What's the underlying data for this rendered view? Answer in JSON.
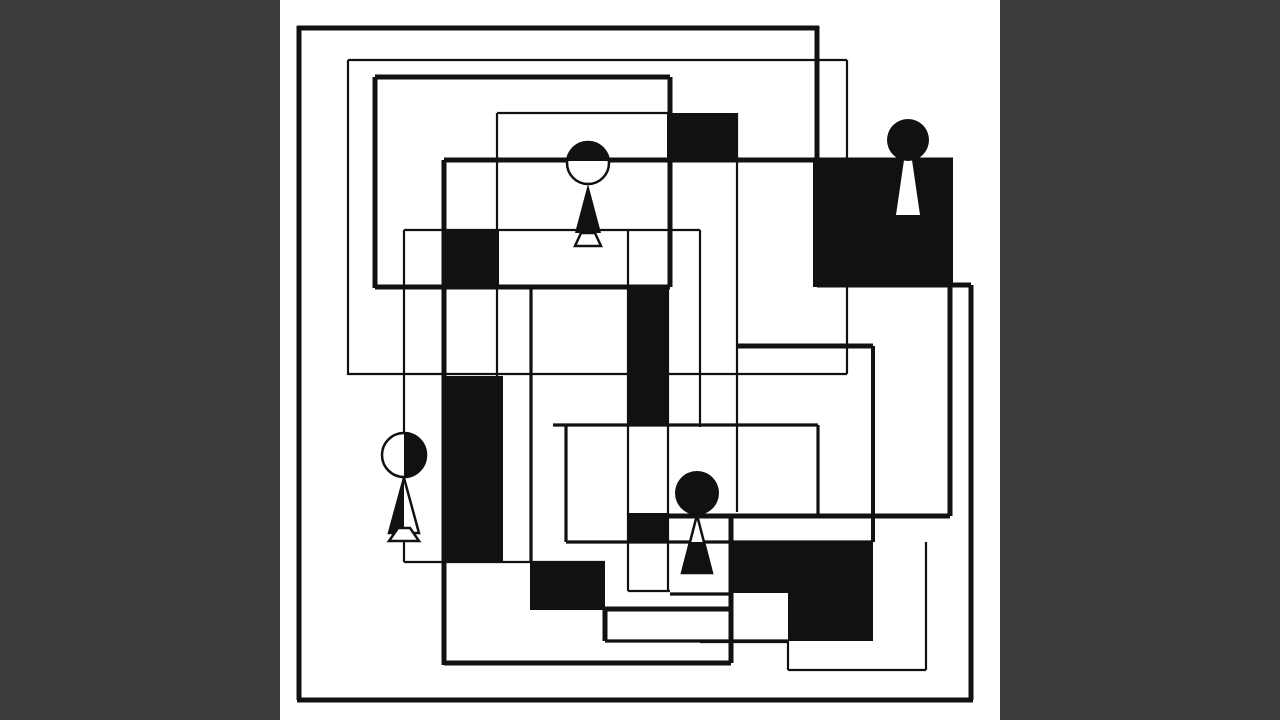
{
  "artwork": {
    "title": "abstract-geometric-composition",
    "canvas_width": 1280,
    "canvas_height": 720,
    "colors": {
      "letterbox": "#3c3c3c",
      "board": "#ffffff",
      "ink": "#111111"
    },
    "board": {
      "x": 280,
      "y": 0,
      "width": 720,
      "height": 720
    },
    "stroke_weights": {
      "thick": 5,
      "medium": 3.2,
      "thin": 2.2
    },
    "filled_blocks": [
      {
        "name": "block-top-center",
        "x": 667,
        "y": 113,
        "w": 70,
        "h": 47
      },
      {
        "name": "block-top-right-square",
        "x": 813,
        "y": 159,
        "w": 140,
        "h": 128
      },
      {
        "name": "block-upper-left-square",
        "x": 444,
        "y": 230,
        "w": 55,
        "h": 57
      },
      {
        "name": "block-left-tall-band",
        "x": 444,
        "y": 376,
        "w": 59,
        "h": 187
      },
      {
        "name": "block-center-tall-band",
        "x": 628,
        "y": 287,
        "w": 40,
        "h": 138
      },
      {
        "name": "block-center-small",
        "x": 628,
        "y": 513,
        "w": 40,
        "h": 28
      },
      {
        "name": "block-bottom-left",
        "x": 530,
        "y": 562,
        "w": 75,
        "h": 48
      },
      {
        "name": "block-bottom-right-a",
        "x": 731,
        "y": 542,
        "w": 142,
        "h": 51
      },
      {
        "name": "block-bottom-right-b",
        "x": 788,
        "y": 593,
        "w": 85,
        "h": 48
      }
    ],
    "segments": [
      {
        "name": "outer-top",
        "x1": 297,
        "y1": 28,
        "x2": 819,
        "y2": 28,
        "w": 5
      },
      {
        "name": "outer-left",
        "x1": 299,
        "y1": 26,
        "x2": 299,
        "y2": 700,
        "w": 5
      },
      {
        "name": "outer-bottom",
        "x1": 297,
        "y1": 700,
        "x2": 973,
        "y2": 700,
        "w": 5
      },
      {
        "name": "outer-right",
        "x1": 971,
        "y1": 285,
        "x2": 971,
        "y2": 700,
        "w": 5
      },
      {
        "name": "right-top-stub",
        "x1": 817,
        "y1": 285,
        "x2": 971,
        "y2": 285,
        "w": 5
      },
      {
        "name": "outer-top-right-drop",
        "x1": 817,
        "y1": 26,
        "x2": 817,
        "y2": 160,
        "w": 5
      },
      {
        "name": "mid-thick-top",
        "x1": 444,
        "y1": 160,
        "x2": 953,
        "y2": 160,
        "w": 5
      },
      {
        "name": "mid-thick-right",
        "x1": 950,
        "y1": 160,
        "x2": 950,
        "y2": 516,
        "w": 5
      },
      {
        "name": "mid-thick-bottom",
        "x1": 628,
        "y1": 516,
        "x2": 950,
        "y2": 516,
        "w": 5
      },
      {
        "name": "mid-thick-left",
        "x1": 444,
        "y1": 160,
        "x2": 444,
        "y2": 665,
        "w": 5
      },
      {
        "name": "lower-thick-bottom",
        "x1": 444,
        "y1": 663,
        "x2": 731,
        "y2": 663,
        "w": 5
      },
      {
        "name": "lower-thick-right",
        "x1": 731,
        "y1": 514,
        "x2": 731,
        "y2": 663,
        "w": 5
      },
      {
        "name": "lower-step-top",
        "x1": 605,
        "y1": 609,
        "x2": 731,
        "y2": 609,
        "w": 5
      },
      {
        "name": "lower-step-left",
        "x1": 605,
        "y1": 609,
        "x2": 605,
        "y2": 641,
        "w": 5
      },
      {
        "name": "lower-step-bottom",
        "x1": 605,
        "y1": 641,
        "x2": 788,
        "y2": 641,
        "w": 3.2
      },
      {
        "name": "tl-rect-top",
        "x1": 375,
        "y1": 77,
        "x2": 670,
        "y2": 77,
        "w": 5
      },
      {
        "name": "tl-rect-left",
        "x1": 375,
        "y1": 77,
        "x2": 375,
        "y2": 288,
        "w": 5
      },
      {
        "name": "tl-rect-bottom",
        "x1": 375,
        "y1": 287,
        "x2": 670,
        "y2": 287,
        "w": 5
      },
      {
        "name": "tl-rect-right",
        "x1": 670,
        "y1": 77,
        "x2": 670,
        "y2": 287,
        "w": 5
      },
      {
        "name": "thin1-top",
        "x1": 348,
        "y1": 60,
        "x2": 847,
        "y2": 60,
        "w": 2.2
      },
      {
        "name": "thin1-left",
        "x1": 348,
        "y1": 60,
        "x2": 348,
        "y2": 375,
        "w": 2.2
      },
      {
        "name": "thin1-bottom",
        "x1": 348,
        "y1": 374,
        "x2": 847,
        "y2": 374,
        "w": 2.2
      },
      {
        "name": "thin1-right",
        "x1": 847,
        "y1": 60,
        "x2": 847,
        "y2": 374,
        "w": 2.2
      },
      {
        "name": "thin2-top",
        "x1": 497,
        "y1": 113,
        "x2": 670,
        "y2": 113,
        "w": 2.2
      },
      {
        "name": "thin2-left",
        "x1": 497,
        "y1": 113,
        "x2": 497,
        "y2": 376,
        "w": 2.2
      },
      {
        "name": "thin3-top",
        "x1": 404,
        "y1": 230,
        "x2": 700,
        "y2": 230,
        "w": 2.2
      },
      {
        "name": "thin3-left",
        "x1": 404,
        "y1": 230,
        "x2": 404,
        "y2": 562,
        "w": 2.2
      },
      {
        "name": "thin3-bottom",
        "x1": 404,
        "y1": 562,
        "x2": 605,
        "y2": 562,
        "w": 2.2
      },
      {
        "name": "thin3-right",
        "x1": 700,
        "y1": 230,
        "x2": 700,
        "y2": 427,
        "w": 2.2
      },
      {
        "name": "mid-medium-h",
        "x1": 553,
        "y1": 425,
        "x2": 818,
        "y2": 425,
        "w": 3.2
      },
      {
        "name": "mid-medium-v",
        "x1": 818,
        "y1": 425,
        "x2": 818,
        "y2": 516,
        "w": 3.2
      },
      {
        "name": "left-medium-v",
        "x1": 531,
        "y1": 287,
        "x2": 531,
        "y2": 562,
        "w": 3.2
      },
      {
        "name": "d-rect-left",
        "x1": 566,
        "y1": 425,
        "x2": 566,
        "y2": 542,
        "w": 3.2
      },
      {
        "name": "d-rect-bottom",
        "x1": 566,
        "y1": 542,
        "x2": 873,
        "y2": 542,
        "w": 3.2
      },
      {
        "name": "d-rect-right",
        "x1": 873,
        "y1": 346,
        "x2": 873,
        "y2": 542,
        "w": 4
      },
      {
        "name": "t-rect-top",
        "x1": 736,
        "y1": 346,
        "x2": 873,
        "y2": 346,
        "w": 5
      },
      {
        "name": "t-rect-left",
        "x1": 737,
        "y1": 113,
        "x2": 737,
        "y2": 512,
        "w": 2.2
      },
      {
        "name": "band-left",
        "x1": 628,
        "y1": 230,
        "x2": 628,
        "y2": 591,
        "w": 2.2
      },
      {
        "name": "band-right",
        "x1": 668,
        "y1": 287,
        "x2": 668,
        "y2": 591,
        "w": 2.2
      },
      {
        "name": "band-bottom",
        "x1": 628,
        "y1": 591,
        "x2": 670,
        "y2": 591,
        "w": 2.2
      },
      {
        "name": "band-notch-top",
        "x1": 670,
        "y1": 594,
        "x2": 731,
        "y2": 594,
        "w": 3.2
      },
      {
        "name": "bottom-thin-h",
        "x1": 700,
        "y1": 642,
        "x2": 788,
        "y2": 642,
        "w": 2.2
      },
      {
        "name": "br-rect-right",
        "x1": 926,
        "y1": 542,
        "x2": 926,
        "y2": 670,
        "w": 2.2
      },
      {
        "name": "br-rect-bottom",
        "x1": 788,
        "y1": 670,
        "x2": 926,
        "y2": 670,
        "w": 2.2
      },
      {
        "name": "br-rect-left",
        "x1": 788,
        "y1": 640,
        "x2": 788,
        "y2": 670,
        "w": 2.2
      }
    ],
    "figures": [
      {
        "name": "figure-top",
        "head": {
          "cx": 588,
          "cy": 163,
          "r": 21,
          "style": "cap-top-black",
          "cap_y": 161
        },
        "body": {
          "cx": 588,
          "neck_y": 184,
          "bottom_y": 233,
          "half_width": 13,
          "style": "black"
        },
        "feet": {
          "top_y": 233,
          "bottom_y": 246,
          "top_hw": 7,
          "bottom_hw": 13,
          "style": "white-outline"
        }
      },
      {
        "name": "figure-left",
        "head": {
          "cx": 404,
          "cy": 455,
          "r": 22,
          "style": "right-half-black"
        },
        "body": {
          "cx": 404,
          "neck_y": 478,
          "bottom_y": 533,
          "half_width": 15,
          "style": "outline-left-half-black"
        },
        "feet": {
          "top_y": 528,
          "bottom_y": 541,
          "top_hw": 6,
          "bottom_hw": 15,
          "style": "white-outline"
        }
      },
      {
        "name": "figure-right",
        "head": {
          "cx": 908,
          "cy": 140,
          "r": 21,
          "style": "black"
        },
        "body": {
          "cx": 908,
          "neck_y": 160,
          "bottom_y": 215,
          "half_width": 12,
          "top_hw": 4,
          "style": "white-on-black"
        }
      },
      {
        "name": "figure-bottom",
        "head": {
          "cx": 697,
          "cy": 493,
          "r": 22,
          "style": "black"
        },
        "body": {
          "cx": 697,
          "neck_y": 515,
          "bottom_y": 573,
          "half_width": 15,
          "style": "outline-lower-black",
          "split_y": 542
        }
      }
    ]
  }
}
